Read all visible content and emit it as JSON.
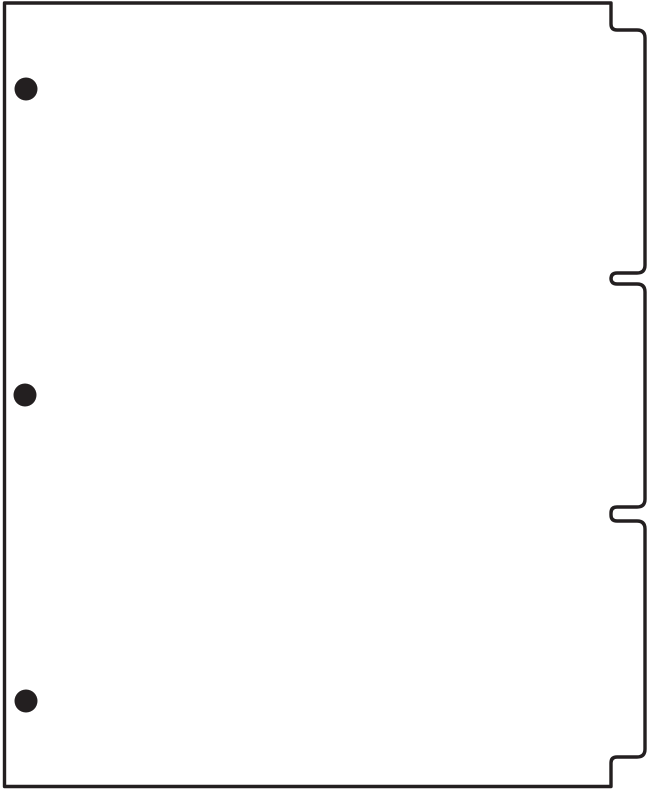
{
  "canvas": {
    "width": 650,
    "height": 792,
    "background_color": "#ffffff"
  },
  "divider_sheet": {
    "description": "blank three-tab binder divider page, line illustration, no text",
    "outline_color": "#231f20",
    "fill_color": "#ffffff",
    "stroke_width": 3.4,
    "sheet": {
      "left": 4.5,
      "top": 3,
      "right": 611,
      "bottom": 786.5
    },
    "tab_outer_x": 645,
    "tab_corner_radius": 8,
    "tab_junction_radius": 6,
    "tabs": [
      {
        "name": "tab-1",
        "top": 30,
        "bottom": 273
      },
      {
        "name": "tab-2",
        "top": 284,
        "bottom": 507
      },
      {
        "name": "tab-3",
        "top": 521,
        "bottom": 757
      }
    ],
    "holes": {
      "color": "#231f20",
      "radius": 11.5,
      "centers": [
        {
          "x": 26,
          "y": 89
        },
        {
          "x": 25,
          "y": 395
        },
        {
          "x": 26,
          "y": 701
        }
      ]
    }
  }
}
